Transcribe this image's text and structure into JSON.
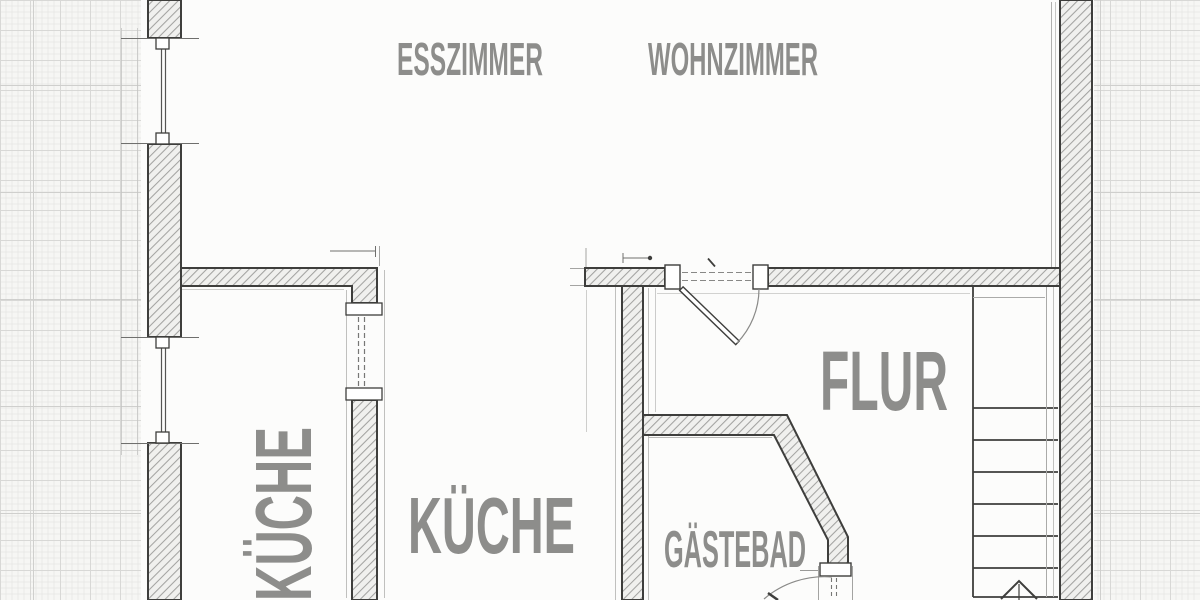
{
  "document": {
    "type": "floor-plan",
    "style": "architectural blueprint on graph paper",
    "language": "German"
  },
  "labels": {
    "esszimmer": "ESSZIMMER",
    "wohnzimmer": "WOHNZIMMER",
    "kueche_vertical": "KÜCHE",
    "kueche": "KÜCHE",
    "flur": "FLUR",
    "gaestebad": "GÄSTEBAD"
  },
  "colors": {
    "background": "#fcfcfb",
    "graph_paper": "#f6f6f4",
    "grid_minor": "#e7e7e5",
    "grid_medium": "#d8d8d6",
    "grid_major": "#cfcfcd",
    "wall_outline": "#3e3e3c",
    "wall_hatch": "#a3a3a1",
    "wall_fill": "#f0f0ee",
    "thin_line": "#b9b9b7",
    "label_text": "#8d8d8b"
  },
  "features": [
    "left-exterior-wall-with-two-windows",
    "right-exterior-wall",
    "entry-door-with-swing-arc",
    "kitchen-pocket-door-dashed",
    "gaestebad-door-with-swing-arc",
    "diagonal-bathroom-wall",
    "staircase-six-treads",
    "stairs-direction-up-arrow",
    "dimension-leader-lines",
    "graph-paper-margins"
  ]
}
